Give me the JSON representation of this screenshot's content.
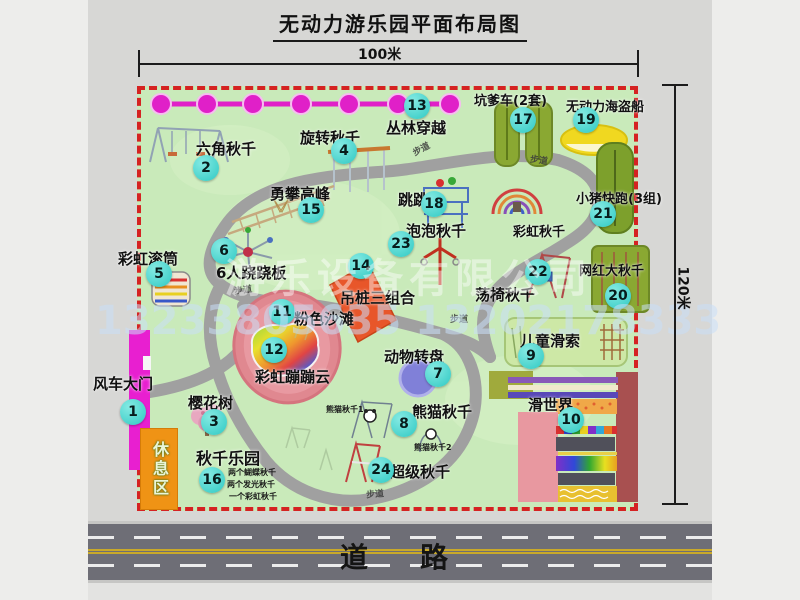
{
  "title": "无动力游乐园平面布局图",
  "dimensions": {
    "width_label": "100米",
    "height_label": "120米"
  },
  "road": {
    "label": "道　路"
  },
  "watermark": {
    "company": "游乐设备有限公司",
    "phone": "13233805635 13202178333"
  },
  "rest_area": {
    "label": "休息区"
  },
  "path_label": "步道",
  "extra_labels": {
    "rainbow_swing": "彩虹秋千"
  },
  "sub_labels": {
    "panda1": "熊猫秋千1",
    "panda2": "熊猫秋千2",
    "swing_lines": [
      "两个蝴蝶秋千",
      "两个发光秋千",
      "一个彩虹秋千"
    ]
  },
  "attractions": [
    {
      "num": "1",
      "name": "风车大门"
    },
    {
      "num": "2",
      "name": "六角秋千"
    },
    {
      "num": "3",
      "name": "樱花树"
    },
    {
      "num": "4",
      "name": "旋转秋千"
    },
    {
      "num": "5",
      "name": "彩虹滚筒"
    },
    {
      "num": "6",
      "name": "6人跷跷板"
    },
    {
      "num": "7",
      "name": "动物转盘"
    },
    {
      "num": "8",
      "name": "熊猫秋千"
    },
    {
      "num": "9",
      "name": "儿童滑索"
    },
    {
      "num": "10",
      "name": "滑世界"
    },
    {
      "num": "11",
      "name": "粉色沙滩"
    },
    {
      "num": "12",
      "name": "彩虹蹦蹦云"
    },
    {
      "num": "13",
      "name": "丛林穿越"
    },
    {
      "num": "14",
      "name": "吊桩三组合"
    },
    {
      "num": "15",
      "name": "勇攀高峰"
    },
    {
      "num": "16",
      "name": "秋千乐园"
    },
    {
      "num": "17",
      "name": "坑爹车(2套)"
    },
    {
      "num": "18",
      "name": "跳跳马"
    },
    {
      "num": "19",
      "name": "无动力海盗船"
    },
    {
      "num": "20",
      "name": "网红大秋千"
    },
    {
      "num": "21",
      "name": "小猪快跑(3组)"
    },
    {
      "num": "22",
      "name": "荡椅秋千"
    },
    {
      "num": "23",
      "name": "泡泡秋千"
    },
    {
      "num": "24",
      "name": "超级秋千"
    }
  ],
  "colors": {
    "park_green": "#c9eaba",
    "border_red": "#d52222",
    "badge_cyan": "#2fc9c3",
    "gate_magenta": "#e81fd0",
    "zipline_magenta": "#e020c8",
    "road_gray": "#6e6e76",
    "rest_area_orange": "#ef9315"
  }
}
